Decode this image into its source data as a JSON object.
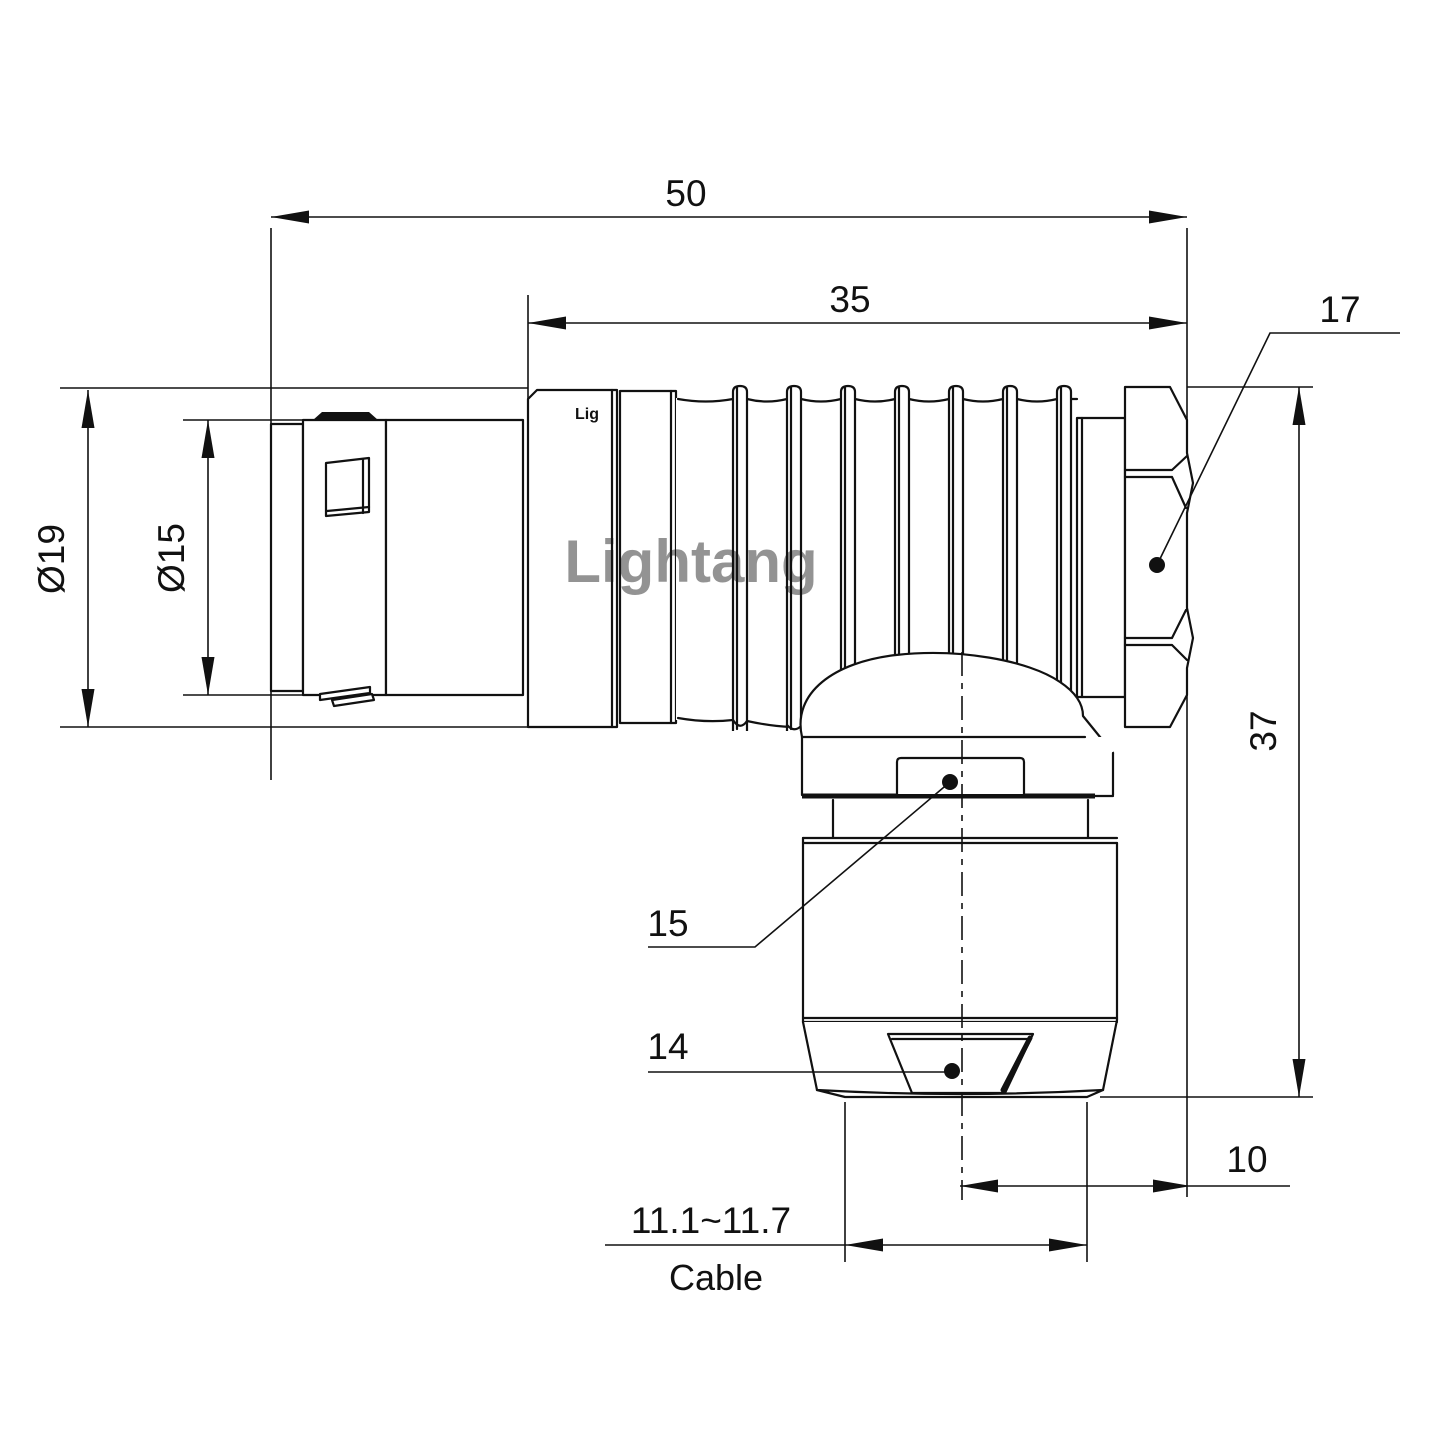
{
  "drawing": {
    "colors": {
      "line": "#111111",
      "watermark_pink": "#f5b9c6"
    },
    "watermark_text": "Lightang",
    "shell_brand_text": "Lig",
    "dims": {
      "overall_length": "50",
      "rear_length": "35",
      "hex_across_flats": "17",
      "outer_dia": "Ø19",
      "front_dia": "Ø15",
      "overall_height": "37",
      "flat_15": "15",
      "flat_14": "14",
      "axis_to_face": "10",
      "cable_dia_range": "11.1~11.7",
      "cable_word": "Cable"
    }
  }
}
